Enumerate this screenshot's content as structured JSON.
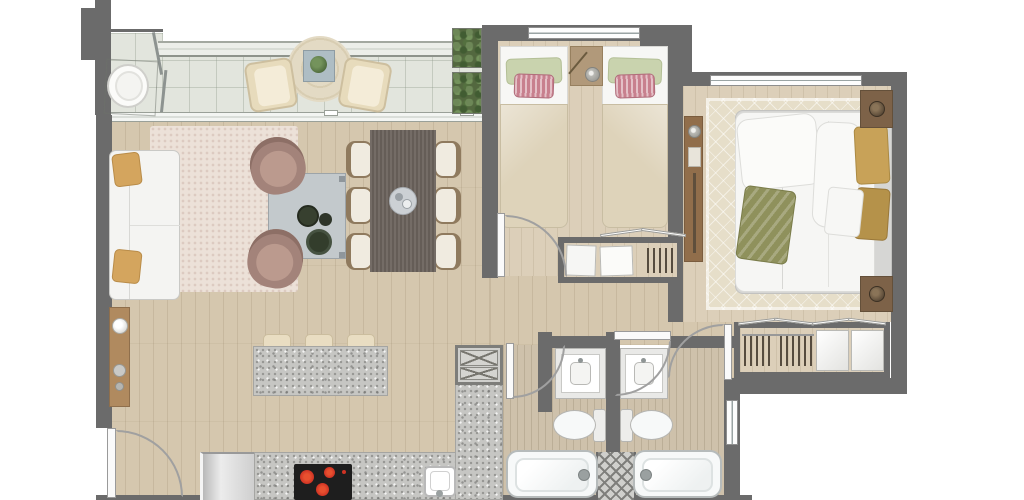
{
  "meta": {
    "description": "rendered top-down architectural floor plan of an apartment",
    "canvas_w": 1024,
    "canvas_h": 500
  },
  "colors": {
    "outside": "#ffffff",
    "wall": "#6b6b6b",
    "tile": "#e2e5dd",
    "wood": "#d5c7ae",
    "wood_light": "#dccfb9",
    "wood_bath": "#cec1ab",
    "glass": "#eceee9",
    "rug_living": "#ece1d8",
    "rug_master": "#e6dec9",
    "rug_round": "#e3dac4",
    "sofa": "#f4f4f2",
    "pillow_gold": "#d4a55e",
    "armchair": "#a3837a",
    "armchair_light": "#bb9a8e",
    "coffee_table": "#c3c9cc",
    "plate_dark": "#37402f",
    "dining_table": "#6b635c",
    "chair_frame": "#8f7a5e",
    "chair_cushion": "#f0ebe0",
    "granite": "#c6c6c3",
    "stool": "#e9ddc2",
    "cooktop": "#1e1e1e",
    "burner": "#cf3324",
    "fixture": "#f7f9f9",
    "fixture_line": "#b6bbbb",
    "sheet": "#f7f7f5",
    "blanket": "#ded3ba",
    "pillow_green": "#c9d3ae",
    "pillow_pink": "#c8808e",
    "wood_furn": "#b1997a",
    "wood_dark": "#7d6248",
    "duvet": "#f6f6f4",
    "mattress": "#d6d6d4",
    "pillow_gold2": "#c8a258",
    "throw_olive": "#8f915c",
    "clothes": "#564c3f",
    "door_leaf": "#fafafa",
    "arc": "#a0a0a0",
    "plant": "#53683f",
    "console_wood": "#b08a5f",
    "lamp_dark": "#4f4030"
  },
  "structure": {
    "rooms": [
      "balcony",
      "living-room",
      "dining-area",
      "kitchen",
      "hallway",
      "twin-bedroom",
      "master-bedroom",
      "bathroom-1",
      "bathroom-2",
      "hallway-closet",
      "master-closet"
    ],
    "doors": [
      "entry-door",
      "twin-bedroom-door",
      "master-bedroom-door",
      "bathroom-1-door",
      "bathroom-2-door",
      "balcony-sliding-door"
    ],
    "windows": [
      "twin-bedroom-window",
      "master-bedroom-window",
      "bathroom-2-window",
      "balcony-glass-railing"
    ]
  },
  "furniture": {
    "balcony": [
      "hanging-egg-chair",
      "lounge-chair",
      "lounge-chair",
      "round-rug",
      "side-table-with-plant",
      "vertical-garden-planter"
    ],
    "living_room": [
      "sofa",
      "gold-throw-pillow",
      "gold-throw-pillow",
      "area-rug",
      "coffee-table-with-plates",
      "swivel-armchair",
      "swivel-armchair",
      "wall-console"
    ],
    "dining_area": [
      "dining-table",
      "dining-chair",
      "dining-chair",
      "dining-chair",
      "dining-chair",
      "dining-chair",
      "dining-chair",
      "centerpiece-tray"
    ],
    "kitchen": [
      "island-counter",
      "bar-stool",
      "bar-stool",
      "bar-stool",
      "refrigerator",
      "cooktop",
      "sink",
      "base-counter",
      "tall-cabinet"
    ],
    "twin_bedroom": [
      "single-bed",
      "single-bed",
      "nightstand",
      "table-lamp"
    ],
    "master_bedroom": [
      "double-bed",
      "nightstand",
      "nightstand",
      "table-lamp",
      "table-lamp",
      "console-shelf",
      "area-rug",
      "olive-throw"
    ],
    "bathroom_1": [
      "vanity-sink",
      "toilet",
      "bathtub",
      "faucet"
    ],
    "bathroom_2": [
      "vanity-sink",
      "toilet",
      "bathtub",
      "faucet"
    ],
    "closets": [
      "hallway-closet-panels",
      "step-stool",
      "master-closet-rail",
      "sliding-doors"
    ]
  }
}
